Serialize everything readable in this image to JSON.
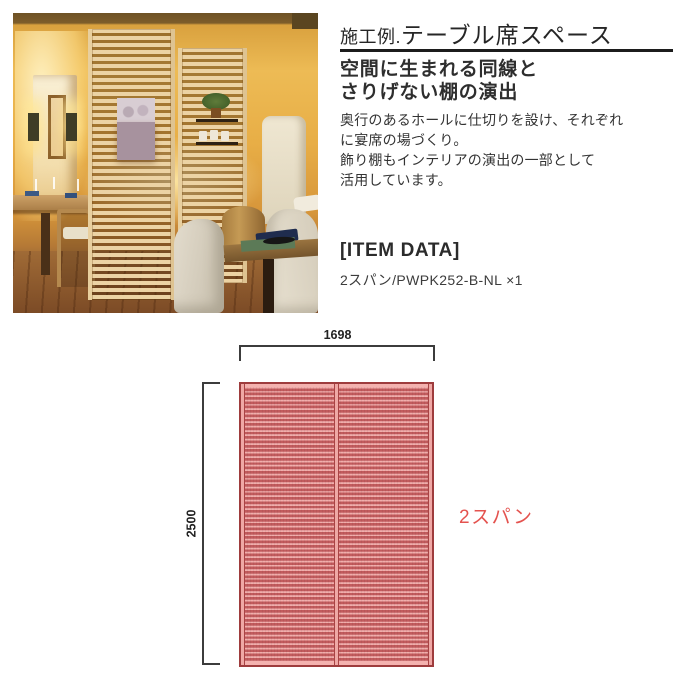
{
  "header": {
    "title_prefix": "施工例.",
    "title_main": "テーブル席スペース"
  },
  "description": {
    "subtitle_lines": [
      "空間に生まれる同線と",
      "さりげない棚の演出"
    ],
    "body_lines": [
      "奥行のあるホールに仕切りを設け、それぞれ",
      "に宴席の場づくり。",
      "飾り棚もインテリアの演出の一部として",
      "活用しています。"
    ]
  },
  "item_data": {
    "heading": "[ITEM DATA]",
    "value": "2スパン/PWPK252-B-NL ×1"
  },
  "diagram": {
    "width_label": "1698",
    "height_label": "2500",
    "span_label": "2スパン",
    "colors": {
      "slat_dark": "#c25b5d",
      "slat_light": "#f1aeac",
      "frame": "#9e3c3d",
      "stile": "#efa8a5",
      "accent_red": "#e4534f",
      "dimension_line": "#3c3c3c"
    }
  },
  "photo": {
    "colors": {
      "wall_warm": "#edbb55",
      "wood_slat": "#ecd3a4",
      "floor": "#a06b36",
      "artwork_mauve": "#a7929e",
      "armchair_cream": "#e3dccd"
    }
  }
}
